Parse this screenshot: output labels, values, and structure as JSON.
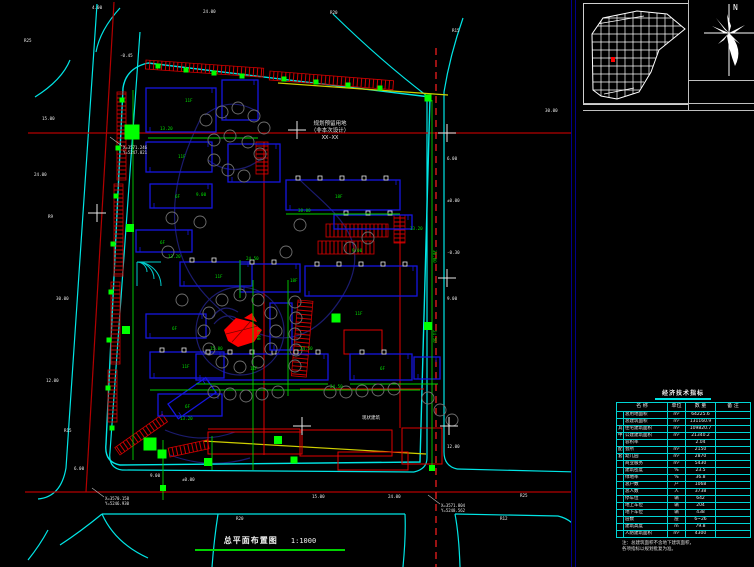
{
  "colors": {
    "background": "#000000",
    "road_edge_cyan": "#00e5e5",
    "centerline_red": "#b40000",
    "dashed_centerline": "#ff2020",
    "building_blue": "#1515e0",
    "dark_blue": "#1b1b6e",
    "green": "#00d200",
    "bright_green": "#00ff00",
    "yellow": "#cfcf00",
    "red": "#e00000",
    "white": "#e8e8e8",
    "tree_gray": "#6f6f6f",
    "panel_navy": "#00008b",
    "table_border": "#00d5d5"
  },
  "titleblock": {
    "title": "总平面布置图",
    "scale": "1:1000"
  },
  "north": {
    "label": "N"
  },
  "parcel": {
    "line1": "规划预留用地",
    "line2": "（非本次设计）",
    "line3": "XX-XX"
  },
  "annotations": {
    "preserved": "现状建筑"
  },
  "coord_notes": [
    {
      "x": 122,
      "y": 146,
      "l1": "X=3571.246",
      "l2": "Y=5247.821"
    },
    {
      "x": 104,
      "y": 497,
      "l1": "X=3570.158",
      "l2": "Y=5246.930"
    },
    {
      "x": 440,
      "y": 504,
      "l1": "X=3571.804",
      "l2": "Y=5248.562"
    }
  ],
  "table": {
    "title": "经济技术指标",
    "headers": [
      "名  称",
      "单位",
      "数 量",
      "备 注"
    ],
    "rows": [
      {
        "g": "",
        "n": "总用地面积",
        "u": "m²",
        "q": "64225.6",
        "b": ""
      },
      {
        "g": "",
        "n": "总建筑面积",
        "u": "m²",
        "q": "131160.9",
        "b": ""
      },
      {
        "g": "其",
        "n": "住宅建筑面积",
        "u": "m²",
        "q": "109820.7",
        "b": ""
      },
      {
        "g": "中",
        "n": "公建建筑面积",
        "u": "m²",
        "q": "21340.2",
        "b": ""
      },
      {
        "g": "",
        "n": "容积率",
        "u": "",
        "q": "2.04",
        "b": ""
      },
      {
        "g": "配",
        "n": "会所",
        "u": "m²",
        "q": "2150",
        "b": ""
      },
      {
        "g": "套",
        "n": "幼儿园",
        "u": "m²",
        "q": "2870",
        "b": ""
      },
      {
        "g": "",
        "n": "商业服务",
        "u": "m²",
        "q": "5430",
        "b": ""
      },
      {
        "g": "",
        "n": "建筑密度",
        "u": "%",
        "q": "23.5",
        "b": ""
      },
      {
        "g": "",
        "n": "绿地率",
        "u": "%",
        "q": "36.8",
        "b": ""
      },
      {
        "g": "",
        "n": "总户数",
        "u": "户",
        "q": "1068",
        "b": ""
      },
      {
        "g": "",
        "n": "总人数",
        "u": "人",
        "q": "3738",
        "b": ""
      },
      {
        "g": "",
        "n": "停车位",
        "u": "辆",
        "q": "642",
        "b": ""
      },
      {
        "g": "",
        "n": "地上车位",
        "u": "辆",
        "q": "204",
        "b": ""
      },
      {
        "g": "",
        "n": "地下车位",
        "u": "辆",
        "q": "438",
        "b": ""
      },
      {
        "g": "",
        "n": "层数",
        "u": "层",
        "q": "6~26",
        "b": ""
      },
      {
        "g": "",
        "n": "建筑高度",
        "u": "m",
        "q": "79.8",
        "b": ""
      },
      {
        "g": "",
        "n": "人防建筑面积",
        "u": "m²",
        "q": "4300",
        "b": ""
      }
    ],
    "notes": [
      "注：总建筑面积不含地下建筑面积，",
      "各项指标以规划批复为准。"
    ]
  },
  "plan": {
    "buildings": [
      [
        146,
        88,
        70,
        44,
        0,
        0
      ],
      [
        222,
        80,
        36,
        40,
        0,
        0
      ],
      [
        146,
        142,
        66,
        30,
        0,
        0
      ],
      [
        150,
        184,
        62,
        24,
        0,
        0
      ],
      [
        136,
        230,
        56,
        22,
        0,
        0
      ],
      [
        228,
        144,
        52,
        38,
        0,
        0
      ],
      [
        180,
        262,
        72,
        24,
        0,
        2
      ],
      [
        240,
        264,
        60,
        28,
        0,
        2
      ],
      [
        286,
        180,
        114,
        30,
        0,
        5
      ],
      [
        334,
        215,
        78,
        14,
        0,
        3
      ],
      [
        305,
        266,
        112,
        30,
        0,
        5
      ],
      [
        146,
        314,
        60,
        24,
        0,
        0
      ],
      [
        150,
        352,
        74,
        26,
        0,
        2
      ],
      [
        158,
        394,
        64,
        22,
        0,
        0
      ],
      [
        196,
        354,
        132,
        26,
        0,
        6
      ],
      [
        350,
        354,
        62,
        26,
        0,
        2
      ],
      [
        414,
        357,
        26,
        22,
        0,
        0
      ],
      [
        270,
        303,
        22,
        47,
        0,
        0
      ],
      [
        168,
        404,
        46,
        18,
        -35,
        0
      ]
    ],
    "red_rects": [
      [
        208,
        432,
        94,
        22
      ],
      [
        300,
        430,
        92,
        26
      ],
      [
        338,
        452,
        70,
        18
      ],
      [
        402,
        428,
        40,
        36
      ],
      [
        344,
        330,
        38,
        24
      ]
    ],
    "trees": [
      [
        276,
        331
      ],
      [
        271,
        349
      ],
      [
        258,
        362
      ],
      [
        240,
        367
      ],
      [
        222,
        362
      ],
      [
        209,
        349
      ],
      [
        204,
        331
      ],
      [
        209,
        313
      ],
      [
        222,
        300
      ],
      [
        240,
        295
      ],
      [
        258,
        300
      ],
      [
        271,
        313
      ],
      [
        206,
        120
      ],
      [
        222,
        112
      ],
      [
        238,
        108
      ],
      [
        254,
        116
      ],
      [
        264,
        128
      ],
      [
        214,
        140
      ],
      [
        230,
        136
      ],
      [
        248,
        142
      ],
      [
        260,
        154
      ],
      [
        214,
        160
      ],
      [
        228,
        170
      ],
      [
        244,
        176
      ],
      [
        295,
        302
      ],
      [
        296,
        318
      ],
      [
        295,
        334
      ],
      [
        296,
        350
      ],
      [
        295,
        366
      ],
      [
        214,
        392
      ],
      [
        230,
        394
      ],
      [
        246,
        396
      ],
      [
        262,
        394
      ],
      [
        278,
        392
      ],
      [
        330,
        392
      ],
      [
        346,
        392
      ],
      [
        362,
        391
      ],
      [
        378,
        390
      ],
      [
        394,
        389
      ],
      [
        168,
        252
      ],
      [
        182,
        300
      ],
      [
        350,
        248
      ],
      [
        368,
        238
      ],
      [
        300,
        225
      ],
      [
        286,
        252
      ],
      [
        428,
        398
      ],
      [
        440,
        410
      ],
      [
        452,
        420
      ],
      [
        200,
        222
      ],
      [
        172,
        218
      ]
    ],
    "green_squares": [
      [
        158,
        66,
        5
      ],
      [
        186,
        70,
        5
      ],
      [
        214,
        73,
        5
      ],
      [
        242,
        76,
        5
      ],
      [
        284,
        79,
        5
      ],
      [
        316,
        82,
        5
      ],
      [
        348,
        85,
        5
      ],
      [
        380,
        88,
        5
      ],
      [
        122,
        100,
        5
      ],
      [
        118,
        148,
        5
      ],
      [
        116,
        196,
        5
      ],
      [
        113,
        244,
        5
      ],
      [
        111,
        292,
        5
      ],
      [
        109,
        340,
        5
      ],
      [
        108,
        388,
        5
      ],
      [
        112,
        428,
        5
      ],
      [
        132,
        132,
        15
      ],
      [
        150,
        444,
        13
      ],
      [
        162,
        454,
        9
      ],
      [
        208,
        462,
        8
      ],
      [
        336,
        318,
        9
      ],
      [
        428,
        326,
        8
      ],
      [
        278,
        440,
        8
      ],
      [
        294,
        460,
        7
      ],
      [
        428,
        98,
        7
      ],
      [
        130,
        228,
        8
      ],
      [
        126,
        330,
        8
      ],
      [
        163,
        488,
        6
      ],
      [
        432,
        468,
        6
      ]
    ],
    "crosses": [
      [
        97,
        213
      ],
      [
        297,
        130
      ],
      [
        447,
        133
      ],
      [
        447,
        278
      ],
      [
        302,
        426
      ],
      [
        449,
        426
      ]
    ],
    "labels": [
      {
        "x": 24,
        "y": 42,
        "t": "R25",
        "c": "w"
      },
      {
        "x": 92,
        "y": 9,
        "t": "4.00",
        "c": "w"
      },
      {
        "x": 203,
        "y": 13,
        "t": "24.00",
        "c": "w"
      },
      {
        "x": 330,
        "y": 14,
        "t": "R20",
        "c": "w"
      },
      {
        "x": 452,
        "y": 32,
        "t": "R15",
        "c": "w"
      },
      {
        "x": 545,
        "y": 112,
        "t": "30.00",
        "c": "w"
      },
      {
        "x": 447,
        "y": 160,
        "t": "6.00",
        "c": "w"
      },
      {
        "x": 447,
        "y": 202,
        "t": "±0.00",
        "c": "w"
      },
      {
        "x": 447,
        "y": 254,
        "t": "-0.30",
        "c": "w"
      },
      {
        "x": 447,
        "y": 300,
        "t": "9.00",
        "c": "w"
      },
      {
        "x": 447,
        "y": 448,
        "t": "12.00",
        "c": "w"
      },
      {
        "x": 500,
        "y": 520,
        "t": "R12",
        "c": "w"
      },
      {
        "x": 42,
        "y": 120,
        "t": "15.00",
        "c": "w"
      },
      {
        "x": 34,
        "y": 176,
        "t": "24.00",
        "c": "w"
      },
      {
        "x": 48,
        "y": 218,
        "t": "R9",
        "c": "w"
      },
      {
        "x": 56,
        "y": 300,
        "t": "30.00",
        "c": "w"
      },
      {
        "x": 46,
        "y": 382,
        "t": "12.00",
        "c": "w"
      },
      {
        "x": 64,
        "y": 432,
        "t": "R15",
        "c": "w"
      },
      {
        "x": 74,
        "y": 470,
        "t": "6.00",
        "c": "w"
      },
      {
        "x": 150,
        "y": 477,
        "t": "9.00",
        "c": "w"
      },
      {
        "x": 182,
        "y": 481,
        "t": "±0.00",
        "c": "w"
      },
      {
        "x": 236,
        "y": 520,
        "t": "R20",
        "c": "w"
      },
      {
        "x": 312,
        "y": 498,
        "t": "15.00",
        "c": "w"
      },
      {
        "x": 388,
        "y": 498,
        "t": "24.00",
        "c": "w"
      },
      {
        "x": 520,
        "y": 497,
        "t": "R25",
        "c": "w"
      },
      {
        "x": 120,
        "y": 57,
        "t": "-0.45",
        "c": "w"
      },
      {
        "x": 168,
        "y": 258,
        "t": "13.20",
        "c": "g"
      },
      {
        "x": 246,
        "y": 260,
        "t": "24.50",
        "c": "g"
      },
      {
        "x": 298,
        "y": 212,
        "t": "38.00",
        "c": "g"
      },
      {
        "x": 210,
        "y": 350,
        "t": "15.00",
        "c": "g"
      },
      {
        "x": 300,
        "y": 350,
        "t": "24.50",
        "c": "g"
      },
      {
        "x": 352,
        "y": 252,
        "t": "9.00",
        "c": "g"
      },
      {
        "x": 410,
        "y": 230,
        "t": "13.20",
        "c": "g"
      },
      {
        "x": 433,
        "y": 250,
        "t": "30.00",
        "c": "g",
        "r": 90
      },
      {
        "x": 433,
        "y": 330,
        "t": "24.50",
        "c": "g",
        "r": 90
      },
      {
        "x": 257,
        "y": 330,
        "t": "6.00",
        "c": "g",
        "r": 90
      },
      {
        "x": 160,
        "y": 130,
        "t": "13.20",
        "c": "g"
      },
      {
        "x": 196,
        "y": 196,
        "t": "9.00",
        "c": "g"
      },
      {
        "x": 330,
        "y": 388,
        "t": "24.50",
        "c": "g"
      },
      {
        "x": 180,
        "y": 420,
        "t": "13.20",
        "c": "g"
      },
      {
        "x": 185,
        "y": 102,
        "t": "11F",
        "c": "g"
      },
      {
        "x": 178,
        "y": 158,
        "t": "11F",
        "c": "g"
      },
      {
        "x": 175,
        "y": 198,
        "t": "6F",
        "c": "g"
      },
      {
        "x": 160,
        "y": 244,
        "t": "6F",
        "c": "g"
      },
      {
        "x": 215,
        "y": 278,
        "t": "11F",
        "c": "g"
      },
      {
        "x": 172,
        "y": 330,
        "t": "6F",
        "c": "g"
      },
      {
        "x": 182,
        "y": 368,
        "t": "11F",
        "c": "g"
      },
      {
        "x": 185,
        "y": 408,
        "t": "6F",
        "c": "g"
      },
      {
        "x": 335,
        "y": 198,
        "t": "18F",
        "c": "g"
      },
      {
        "x": 290,
        "y": 282,
        "t": "18F",
        "c": "g"
      },
      {
        "x": 355,
        "y": 315,
        "t": "11F",
        "c": "g"
      },
      {
        "x": 250,
        "y": 370,
        "t": "11F",
        "c": "g"
      },
      {
        "x": 380,
        "y": 370,
        "t": "6F",
        "c": "g"
      }
    ]
  }
}
